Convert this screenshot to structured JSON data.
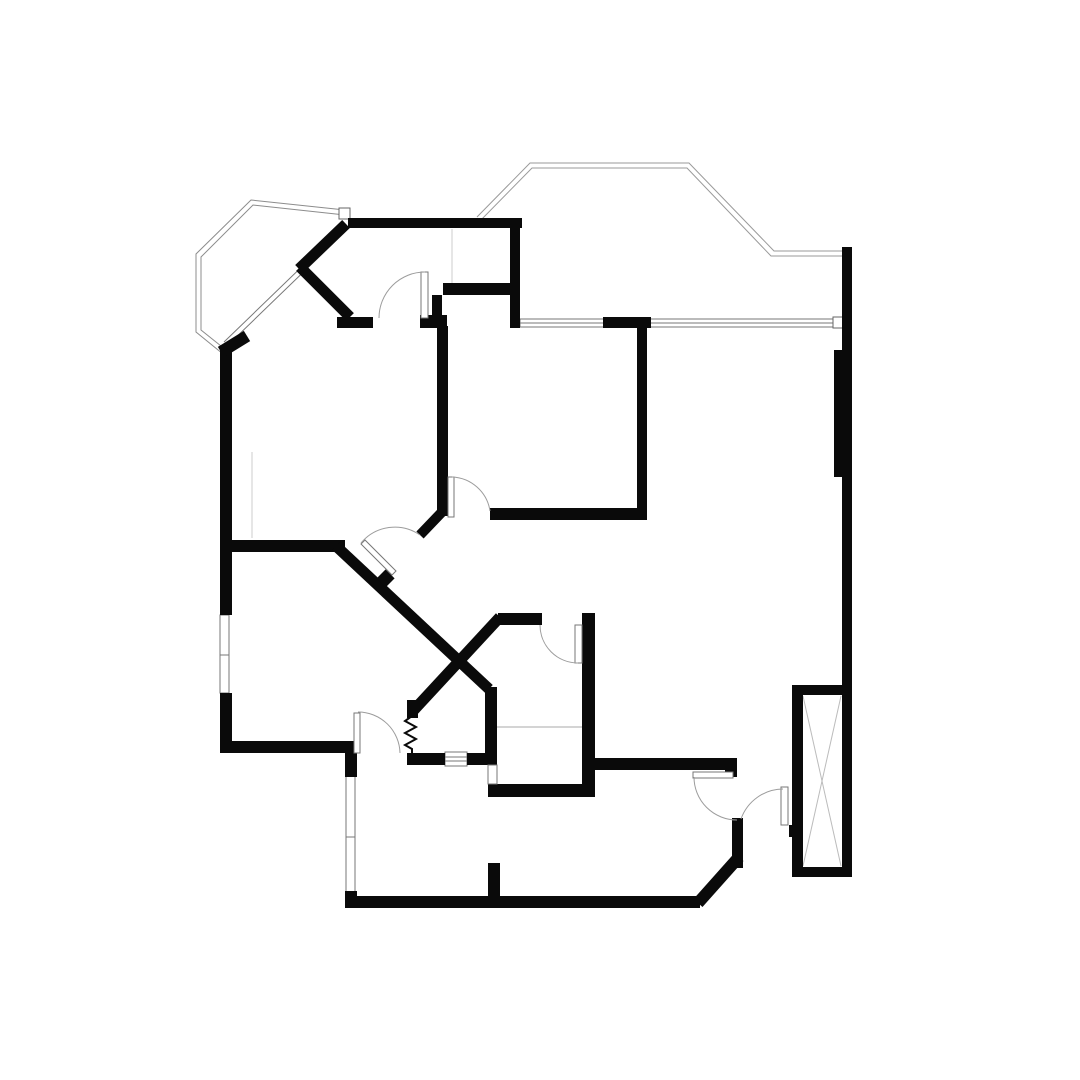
{
  "palette": {
    "background": "#ffffff",
    "wall": "#0a0a0a",
    "thin": "#8c8c8c",
    "outline": "#9a9a9a",
    "arc": "#9c9c9c",
    "faint": "#cccccc",
    "leaf_fill": "#ffffff",
    "leaf_stroke": "#777777"
  },
  "plan": {
    "elements": [
      {
        "kind": "polyline",
        "name": "bay-window-outline-outer",
        "pts": "345,210 251,200 196,254 196,332 223,354",
        "color": "#8c8c8c",
        "w": 1
      },
      {
        "kind": "polyline",
        "name": "bay-window-outline-inner",
        "pts": "345,215 253,205 201,257 201,330 226,350",
        "color": "#8c8c8c",
        "w": 1
      },
      {
        "kind": "rect",
        "name": "bay-outline-corner-cap",
        "x": 339,
        "y": 208,
        "w": 11,
        "h": 11,
        "fill": "#ffffff",
        "stroke": "#666666",
        "sw": 1
      },
      {
        "kind": "line",
        "name": "bay-glazing-line-1",
        "x1": 346,
        "y1": 224,
        "x2": 224,
        "y2": 342,
        "color": "#777777",
        "w": 1
      },
      {
        "kind": "line",
        "name": "bay-glazing-line-2",
        "x1": 350,
        "y1": 227,
        "x2": 228,
        "y2": 345,
        "color": "#777777",
        "w": 1
      },
      {
        "kind": "polyline",
        "name": "terrace-outline-outer",
        "pts": "477,217 530,163 689,163 774,251 843,251",
        "color": "#9a9a9a",
        "w": 1
      },
      {
        "kind": "polyline",
        "name": "terrace-outline-inner",
        "pts": "479,222 532,168 687,168 771,256 843,256",
        "color": "#9a9a9a",
        "w": 1
      },
      {
        "kind": "rect",
        "name": "window-top",
        "x": 520,
        "y": 319,
        "w": 315,
        "h": 8,
        "fill": "#ffffff",
        "stroke": "#777777",
        "sw": 1
      },
      {
        "kind": "line",
        "name": "window-top-midline",
        "x1": 520,
        "y1": 323,
        "x2": 835,
        "y2": 323,
        "color": "#777777",
        "w": 1
      },
      {
        "kind": "rect",
        "name": "window-top-end-cap",
        "x": 833,
        "y": 317,
        "w": 11,
        "h": 11,
        "fill": "#ffffff",
        "stroke": "#666666",
        "sw": 1
      },
      {
        "kind": "rect",
        "name": "window-left",
        "x": 220,
        "y": 615,
        "w": 9,
        "h": 78,
        "fill": "#ffffff",
        "stroke": "#777777",
        "sw": 1
      },
      {
        "kind": "line",
        "name": "window-left-mullion",
        "x1": 220,
        "y1": 655,
        "x2": 229,
        "y2": 655,
        "color": "#777777",
        "w": 1
      },
      {
        "kind": "rect",
        "name": "window-bottom-left",
        "x": 346,
        "y": 775,
        "w": 9,
        "h": 118,
        "fill": "#ffffff",
        "stroke": "#777777",
        "sw": 1
      },
      {
        "kind": "line",
        "name": "window-bottom-left-mullion",
        "x1": 346,
        "y1": 837,
        "x2": 355,
        "y2": 837,
        "color": "#777777",
        "w": 1
      },
      {
        "kind": "rect",
        "name": "window-serving-hatch",
        "x": 445,
        "y": 752,
        "w": 22,
        "h": 14,
        "fill": "#ffffff",
        "stroke": "#777777",
        "sw": 1
      },
      {
        "kind": "line",
        "name": "serving-hatch-line-1",
        "x1": 445,
        "y1": 757,
        "x2": 467,
        "y2": 757,
        "color": "#777777",
        "w": 1
      },
      {
        "kind": "line",
        "name": "serving-hatch-line-2",
        "x1": 445,
        "y1": 761,
        "x2": 467,
        "y2": 761,
        "color": "#777777",
        "w": 1
      },
      {
        "kind": "line",
        "name": "bathroom-fixture-line",
        "x1": 497,
        "y1": 727,
        "x2": 583,
        "y2": 727,
        "color": "#aaaaaa",
        "w": 1
      },
      {
        "kind": "line",
        "name": "closet-line-top",
        "x1": 452,
        "y1": 229,
        "x2": 452,
        "y2": 287,
        "color": "#cccccc",
        "w": 1
      },
      {
        "kind": "line",
        "name": "closet-line-left",
        "x1": 252,
        "y1": 452,
        "x2": 252,
        "y2": 538,
        "color": "#cccccc",
        "w": 1
      },
      {
        "kind": "line",
        "name": "stair-shaft-cross-1",
        "x1": 803,
        "y1": 696,
        "x2": 841,
        "y2": 866,
        "color": "#bbbbbb",
        "w": 1
      },
      {
        "kind": "line",
        "name": "stair-shaft-cross-2",
        "x1": 841,
        "y1": 696,
        "x2": 803,
        "y2": 866,
        "color": "#bbbbbb",
        "w": 1
      },
      {
        "kind": "rect",
        "name": "wall-top",
        "x": 348,
        "y": 218,
        "w": 174,
        "h": 10
      },
      {
        "kind": "rect",
        "name": "wall-dressing-right",
        "x": 510,
        "y": 218,
        "w": 10,
        "h": 110
      },
      {
        "kind": "rect",
        "name": "wall-dressing-bottom",
        "x": 443,
        "y": 283,
        "w": 74,
        "h": 12
      },
      {
        "kind": "rect",
        "name": "wall-bay-door",
        "x": 337,
        "y": 317,
        "w": 36,
        "h": 11
      },
      {
        "kind": "rect",
        "name": "wall-corner-block-a",
        "x": 420,
        "y": 315,
        "w": 27,
        "h": 13
      },
      {
        "kind": "rect",
        "name": "wall-corner-block-b",
        "x": 432,
        "y": 295,
        "w": 10,
        "h": 22
      },
      {
        "kind": "rect",
        "name": "wall-bedroom2-left",
        "x": 437,
        "y": 326,
        "w": 11,
        "h": 190
      },
      {
        "kind": "rect",
        "name": "wall-window-pier",
        "x": 603,
        "y": 317,
        "w": 48,
        "h": 11
      },
      {
        "kind": "rect",
        "name": "wall-bedroom2-right",
        "x": 637,
        "y": 328,
        "w": 10,
        "h": 192
      },
      {
        "kind": "rect",
        "name": "wall-bedroom2-bottom",
        "x": 490,
        "y": 508,
        "w": 157,
        "h": 12
      },
      {
        "kind": "rect",
        "name": "wall-left-upper",
        "x": 220,
        "y": 349,
        "w": 12,
        "h": 266
      },
      {
        "kind": "rect",
        "name": "wall-left-lower",
        "x": 220,
        "y": 693,
        "w": 12,
        "h": 60
      },
      {
        "kind": "rect",
        "name": "wall-room1-bottom",
        "x": 222,
        "y": 540,
        "w": 123,
        "h": 12
      },
      {
        "kind": "rect",
        "name": "wall-room2-bottom",
        "x": 220,
        "y": 741,
        "w": 137,
        "h": 12
      },
      {
        "kind": "rect",
        "name": "wall-jog",
        "x": 345,
        "y": 741,
        "w": 12,
        "h": 36
      },
      {
        "kind": "rect",
        "name": "wall-bottom-left-corner",
        "x": 345,
        "y": 891,
        "w": 12,
        "h": 17
      },
      {
        "kind": "rect",
        "name": "wall-bottom",
        "x": 345,
        "y": 896,
        "w": 355,
        "h": 12
      },
      {
        "kind": "rect",
        "name": "wall-kitchen-top",
        "x": 498,
        "y": 613,
        "w": 44,
        "h": 12
      },
      {
        "kind": "rect",
        "name": "wall-v1",
        "x": 582,
        "y": 613,
        "w": 13,
        "h": 184
      },
      {
        "kind": "rect",
        "name": "wall-bath-bottom",
        "x": 488,
        "y": 784,
        "w": 107,
        "h": 13
      },
      {
        "kind": "rect",
        "name": "wall-v2",
        "x": 485,
        "y": 687,
        "w": 12,
        "h": 78
      },
      {
        "kind": "rect",
        "name": "wall-lower-left",
        "x": 407,
        "y": 753,
        "w": 38,
        "h": 12
      },
      {
        "kind": "rect",
        "name": "wall-lower-right",
        "x": 467,
        "y": 753,
        "w": 21,
        "h": 12
      },
      {
        "kind": "rect",
        "name": "wall-diagB-corner",
        "x": 407,
        "y": 700,
        "w": 11,
        "h": 18
      },
      {
        "kind": "rect",
        "name": "wall-partition-stub",
        "x": 488,
        "y": 863,
        "w": 12,
        "h": 45
      },
      {
        "kind": "rect",
        "name": "wall-dining-top",
        "x": 593,
        "y": 758,
        "w": 144,
        "h": 12
      },
      {
        "kind": "rect",
        "name": "wall-dining-notch",
        "x": 725,
        "y": 770,
        "w": 12,
        "h": 7
      },
      {
        "kind": "rect",
        "name": "wall-entry-vert",
        "x": 732,
        "y": 818,
        "w": 11,
        "h": 50
      },
      {
        "kind": "rect",
        "name": "wall-right",
        "x": 842,
        "y": 247,
        "w": 10,
        "h": 630
      },
      {
        "kind": "rect",
        "name": "wall-right-pilaster",
        "x": 834,
        "y": 350,
        "w": 8,
        "h": 127
      },
      {
        "kind": "rect",
        "name": "stairbox-wall-left",
        "x": 792,
        "y": 685,
        "w": 11,
        "h": 192
      },
      {
        "kind": "rect",
        "name": "stairbox-wall-top",
        "x": 792,
        "y": 685,
        "w": 60,
        "h": 10
      },
      {
        "kind": "rect",
        "name": "stairbox-wall-bottom",
        "x": 792,
        "y": 867,
        "w": 60,
        "h": 10
      },
      {
        "kind": "rect",
        "name": "stairbox-door-stub",
        "x": 789,
        "y": 825,
        "w": 9,
        "h": 12
      },
      {
        "kind": "line",
        "name": "wall-diag-w1",
        "x1": 346,
        "y1": 224,
        "x2": 299,
        "y2": 269,
        "color": "#0a0a0a",
        "w": 11
      },
      {
        "kind": "line",
        "name": "wall-diag-w2",
        "x1": 300,
        "y1": 267,
        "x2": 350,
        "y2": 317,
        "color": "#0a0a0a",
        "w": 11
      },
      {
        "kind": "line",
        "name": "wall-bay-corner",
        "x1": 221,
        "y1": 352,
        "x2": 247,
        "y2": 336,
        "color": "#0a0a0a",
        "w": 12
      },
      {
        "kind": "line",
        "name": "wall-diag-a",
        "x1": 336,
        "y1": 546,
        "x2": 489,
        "y2": 689,
        "color": "#0a0a0a",
        "w": 11
      },
      {
        "kind": "line",
        "name": "wall-diag-door-stub",
        "x1": 442,
        "y1": 512,
        "x2": 420,
        "y2": 535,
        "color": "#0a0a0a",
        "w": 10
      },
      {
        "kind": "line",
        "name": "wall-diag-b",
        "x1": 500,
        "y1": 617,
        "x2": 413,
        "y2": 711,
        "color": "#0a0a0a",
        "w": 11
      },
      {
        "kind": "line",
        "name": "wall-entry-diag",
        "x1": 698,
        "y1": 903,
        "x2": 739,
        "y2": 857,
        "color": "#0a0a0a",
        "w": 12
      },
      {
        "kind": "line",
        "name": "diag-door-hinge-tick",
        "x1": 381,
        "y1": 574,
        "x2": 390,
        "y2": 583,
        "color": "#0a0a0a",
        "w": 13
      },
      {
        "kind": "rect",
        "name": "door-leaf-bay-room",
        "x": 421,
        "y": 272,
        "w": 7,
        "h": 46,
        "fill": "#ffffff",
        "stroke": "#777777",
        "sw": 1
      },
      {
        "kind": "path",
        "name": "door-leaf-diag",
        "d": "M361,544 L365,540 L396,571 L392,575 Z",
        "fill": "#ffffff",
        "color": "#777777",
        "w": 1
      },
      {
        "kind": "rect",
        "name": "door-leaf-bedroom2",
        "x": 448,
        "y": 477,
        "w": 6,
        "h": 40,
        "fill": "#ffffff",
        "stroke": "#777777",
        "sw": 1
      },
      {
        "kind": "rect",
        "name": "door-leaf-kitchen",
        "x": 575,
        "y": 625,
        "w": 7,
        "h": 38,
        "fill": "#ffffff",
        "stroke": "#777777",
        "sw": 1
      },
      {
        "kind": "rect",
        "name": "door-leaf-living",
        "x": 354,
        "y": 713,
        "w": 6,
        "h": 40,
        "fill": "#ffffff",
        "stroke": "#777777",
        "sw": 1
      },
      {
        "kind": "rect",
        "name": "door-leaf-entry",
        "x": 693,
        "y": 772,
        "w": 40,
        "h": 6,
        "fill": "#ffffff",
        "stroke": "#777777",
        "sw": 1
      },
      {
        "kind": "rect",
        "name": "door-leaf-lobby",
        "x": 781,
        "y": 787,
        "w": 7,
        "h": 38,
        "fill": "#ffffff",
        "stroke": "#777777",
        "sw": 1
      },
      {
        "kind": "rect",
        "name": "door-leaf-bath-pocket",
        "x": 488,
        "y": 765,
        "w": 9,
        "h": 19,
        "fill": "#ffffff",
        "stroke": "#777777",
        "sw": 1
      },
      {
        "kind": "path",
        "name": "door-arc-bay-room",
        "d": "M379,318 A46,46 0 0 1 425,272",
        "color": "#9c9c9c",
        "w": 1
      },
      {
        "kind": "path",
        "name": "door-arc-diag",
        "d": "M361,543 A44,44 0 0 1 420,535",
        "color": "#9c9c9c",
        "w": 1
      },
      {
        "kind": "path",
        "name": "door-arc-bedroom2",
        "d": "M452,477 A40,40 0 0 1 490,511",
        "color": "#9c9c9c",
        "w": 1
      },
      {
        "kind": "path",
        "name": "door-arc-kitchen",
        "d": "M540,625 A38,38 0 0 0 578,663",
        "color": "#9c9c9c",
        "w": 1
      },
      {
        "kind": "path",
        "name": "door-arc-living",
        "d": "M358,712 A42,42 0 0 1 400,753",
        "color": "#9c9c9c",
        "w": 1
      },
      {
        "kind": "path",
        "name": "door-arc-entry",
        "d": "M694,777 A43,43 0 0 0 737,820",
        "color": "#9c9c9c",
        "w": 1
      },
      {
        "kind": "path",
        "name": "door-arc-lobby",
        "d": "M741,819 A45,45 0 0 1 783,789",
        "color": "#9c9c9c",
        "w": 1
      },
      {
        "kind": "polyline",
        "name": "plumbing-zigzag",
        "pts": "412,716 405,721 416,727 405,733 416,739 405,745 412,749 412,753",
        "color": "#0a0a0a",
        "w": 2
      }
    ]
  }
}
